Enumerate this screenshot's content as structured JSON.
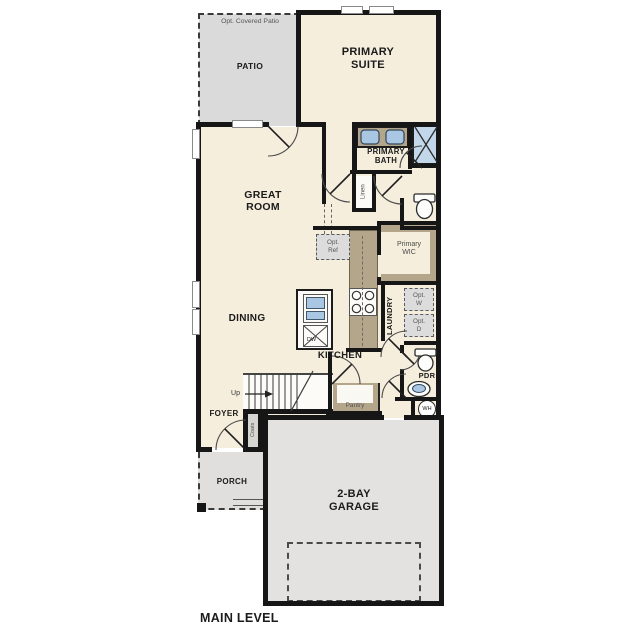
{
  "plan": {
    "title": "MAIN LEVEL",
    "labels": {
      "opt_covered_patio": "Opt. Covered Patio",
      "patio": "PATIO",
      "primary_suite": "PRIMARY SUITE",
      "primary_bath": "PRIMARY BATH",
      "linen": "Linen",
      "great_room": "GREAT ROOM",
      "opt_ref": "Opt. Ref",
      "primary_wic": "Primary WIC",
      "dining": "DINING",
      "kitchen": "KITCHEN",
      "dw": "DW",
      "laundry": "LAUNDRY",
      "opt_w": "Opt. W",
      "opt_d": "Opt. D",
      "pdr": "PDR",
      "wh": "WH",
      "up": "Up",
      "pantry": "Pantry",
      "foyer": "FOYER",
      "coats": "Coats",
      "porch": "PORCH",
      "garage": "2-BAY GARAGE"
    },
    "colors": {
      "wall": "#161616",
      "room_fill": "#f5eedd",
      "patio_fill": "#dadada",
      "garage_fill": "#e3e2e0",
      "porch_fill": "#e0dfdd",
      "cabinet_fill": "#b3a68a",
      "fixture_blue": "#a9c6e2",
      "shower_blue": "#c2d7ea",
      "muted_text": "#555555",
      "label_text": "#1b1b1b"
    }
  }
}
